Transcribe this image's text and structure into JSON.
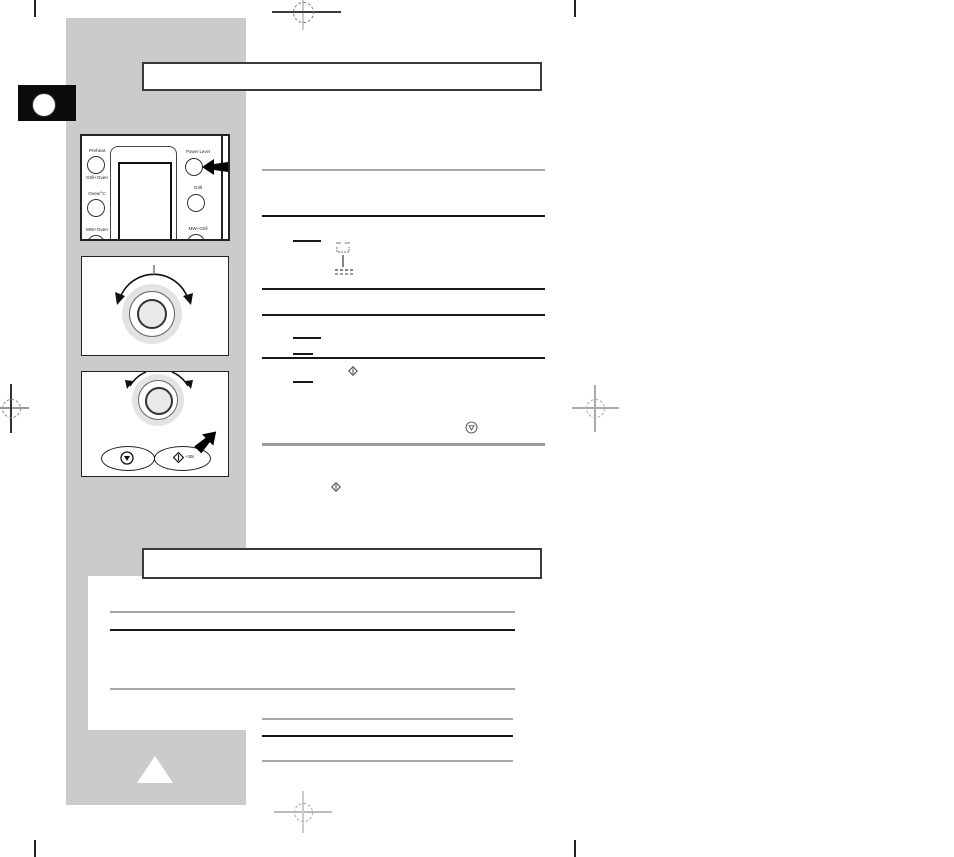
{
  "document": {
    "panel1": {
      "preheat": "Preheat",
      "grill_oven": "Grill+Oven",
      "oven_c": "Oven/°C",
      "mw_oven": "MW+Oven",
      "power_level": "Power Level",
      "grill": "Grill",
      "mw_grill": "MW+Grill"
    },
    "panel3": {
      "start_label": "+30s"
    },
    "colors": {
      "sidebar": "#cbcbcb",
      "panel_background": "#ffffff",
      "line_dark": "#181818",
      "line_gray": "#a6a6a6",
      "callout_arrow": "#000000"
    }
  }
}
